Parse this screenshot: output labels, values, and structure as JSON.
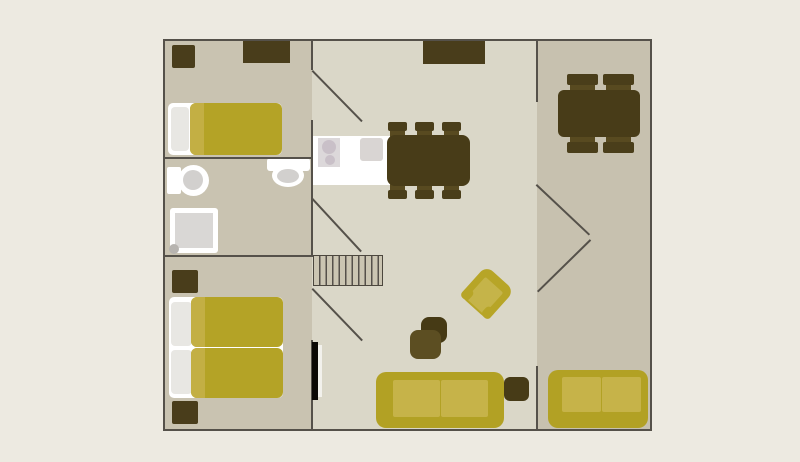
{
  "floorplan": {
    "title": "apartment-floor-plan",
    "background": "#edeae1",
    "palette": {
      "wall": "#55514a",
      "floor_side_rooms": "#c9c3b1",
      "floor_main_room": "#dad7c8",
      "floor_right_room": "#c7c1af",
      "furniture_dark_brown": "#493d1b",
      "table_brown": "#483c18",
      "chair_seat_brown": "#584a20",
      "textile_yellow": "#b4a326",
      "textile_yellow_light": "#c6b349",
      "fixture_white": "#ffffff",
      "fixture_gray": "#d9d6d3",
      "pillow_gray": "#e8e7e3",
      "stairs_fill": "#cbc5b2"
    },
    "layers": [
      {
        "name": "rooms",
        "items": [
          {
            "name": "bedroom-top-floor",
            "x": 163,
            "y": 39,
            "w": 149,
            "h": 119,
            "fill": "#c9c3b1"
          },
          {
            "name": "bathroom-floor",
            "x": 163,
            "y": 158,
            "w": 149,
            "h": 98,
            "fill": "#c9c3b1"
          },
          {
            "name": "bedroom-bottom-floor",
            "x": 163,
            "y": 256,
            "w": 149,
            "h": 175,
            "fill": "#c9c3b1"
          },
          {
            "name": "living-room-floor",
            "x": 312,
            "y": 39,
            "w": 225,
            "h": 392,
            "fill": "#dad7c8"
          },
          {
            "name": "right-room-floor",
            "x": 537,
            "y": 39,
            "w": 115,
            "h": 392,
            "fill": "#c7c1af"
          }
        ]
      },
      {
        "name": "furniture",
        "items": [
          {
            "name": "stairs",
            "x": 313,
            "y": 255,
            "w": 70,
            "h": 31,
            "fill": "#cbc5b2",
            "bg": "repeating-linear-gradient(90deg, rgba(0,0,0,0) 0px, rgba(0,0,0,0) 5.1px, #55504a 5.1px, #55504a 6.5px)",
            "border": "1.5px solid #4c473e"
          },
          {
            "name": "top-bedroom-nightstand",
            "x": 172,
            "y": 45,
            "w": 23,
            "h": 23,
            "fill": "#493d1b",
            "radius": "2px"
          },
          {
            "name": "top-bedroom-dresser",
            "x": 243,
            "y": 40,
            "w": 47,
            "h": 23,
            "fill": "#493d1b"
          },
          {
            "name": "single-bed-base",
            "x": 168,
            "y": 103,
            "w": 114,
            "h": 52,
            "fill": "#ffffff",
            "radius": "5px"
          },
          {
            "name": "single-bed-pillow",
            "x": 171,
            "y": 107,
            "w": 18,
            "h": 44,
            "fill": "#e8e7e3",
            "radius": "4px"
          },
          {
            "name": "single-bed-duvet",
            "x": 190,
            "y": 103,
            "w": 92,
            "h": 52,
            "fill": "#b4a326",
            "radius": "6px"
          },
          {
            "name": "single-bed-duvet-fold",
            "x": 190,
            "y": 103,
            "w": 14,
            "h": 52,
            "fill": "#c3af44",
            "radius": "6px 0 0 6px"
          },
          {
            "name": "toilet-left-tank",
            "x": 167,
            "y": 167,
            "w": 14,
            "h": 27,
            "fill": "#ffffff",
            "radius": "2px"
          },
          {
            "name": "toilet-left-bowl",
            "type": "ellipse",
            "x": 178,
            "y": 165,
            "w": 31,
            "h": 31,
            "fill": "#ffffff"
          },
          {
            "name": "toilet-left-bowl-inner",
            "type": "ellipse",
            "x": 183,
            "y": 170,
            "w": 20,
            "h": 20,
            "fill": "#d2d0ce"
          },
          {
            "name": "toilet-top-tank",
            "x": 267,
            "y": 158,
            "w": 43,
            "h": 13,
            "fill": "#ffffff",
            "radius": "3px"
          },
          {
            "name": "toilet-top-bowl",
            "type": "ellipse",
            "x": 272,
            "y": 164,
            "w": 32,
            "h": 23,
            "fill": "#ffffff"
          },
          {
            "name": "toilet-top-bowl-inner",
            "type": "ellipse",
            "x": 277,
            "y": 169,
            "w": 22,
            "h": 14,
            "fill": "#d2d0ce"
          },
          {
            "name": "shower-base",
            "x": 170,
            "y": 208,
            "w": 48,
            "h": 45,
            "fill": "#ffffff",
            "radius": "3px"
          },
          {
            "name": "shower-tray",
            "x": 175,
            "y": 213,
            "w": 38,
            "h": 35,
            "fill": "#d9d7d5"
          },
          {
            "name": "shower-drain",
            "type": "ellipse",
            "x": 169,
            "y": 244,
            "w": 10,
            "h": 10,
            "fill": "#b7b4b0"
          },
          {
            "name": "bottom-bedroom-nightstand-top",
            "x": 172,
            "y": 270,
            "w": 26,
            "h": 23,
            "fill": "#493d1b",
            "radius": "2px"
          },
          {
            "name": "bottom-bedroom-nightstand-bottom",
            "x": 172,
            "y": 401,
            "w": 26,
            "h": 23,
            "fill": "#493d1b",
            "radius": "2px"
          },
          {
            "name": "double-bed-base",
            "x": 169,
            "y": 297,
            "w": 114,
            "h": 101,
            "fill": "#ffffff",
            "radius": "5px"
          },
          {
            "name": "double-bed-pillow-top",
            "x": 171,
            "y": 302,
            "w": 21,
            "h": 44,
            "fill": "#e8e7e3",
            "radius": "4px"
          },
          {
            "name": "double-bed-pillow-bottom",
            "x": 171,
            "y": 350,
            "w": 21,
            "h": 44,
            "fill": "#e8e7e3",
            "radius": "4px"
          },
          {
            "name": "double-bed-duvet-top",
            "x": 191,
            "y": 297,
            "w": 92,
            "h": 50,
            "fill": "#b4a326",
            "radius": "6px"
          },
          {
            "name": "double-bed-duvet-top-fold",
            "x": 191,
            "y": 297,
            "w": 14,
            "h": 50,
            "fill": "#c3af44",
            "radius": "6px 0 0 6px"
          },
          {
            "name": "double-bed-duvet-bottom",
            "x": 191,
            "y": 348,
            "w": 92,
            "h": 50,
            "fill": "#b4a326",
            "radius": "6px"
          },
          {
            "name": "double-bed-duvet-bottom-fold",
            "x": 191,
            "y": 348,
            "w": 14,
            "h": 50,
            "fill": "#c3af44",
            "radius": "6px 0 0 6px"
          },
          {
            "name": "kitchen-counter",
            "x": 313,
            "y": 136,
            "w": 77,
            "h": 49,
            "fill": "#ffffff"
          },
          {
            "name": "stove-panel",
            "x": 318,
            "y": 138,
            "w": 22,
            "h": 29,
            "fill": "#dcd8da"
          },
          {
            "name": "stove-burner-large",
            "type": "ellipse",
            "x": 322,
            "y": 140,
            "w": 14,
            "h": 14,
            "fill": "#c9c0c8"
          },
          {
            "name": "stove-burner-small",
            "type": "ellipse",
            "x": 325,
            "y": 155,
            "w": 10,
            "h": 10,
            "fill": "#c9c0c8"
          },
          {
            "name": "kitchen-sink",
            "x": 360,
            "y": 138,
            "w": 23,
            "h": 23,
            "fill": "#d9d5d3",
            "radius": "3px"
          },
          {
            "name": "sideboard",
            "x": 423,
            "y": 40,
            "w": 62,
            "h": 24,
            "fill": "#493d1b"
          },
          {
            "name": "dining-chair-seat",
            "x": 390,
            "y": 128,
            "w": 15,
            "h": 10,
            "fill": "#584a20",
            "radius": "2px"
          },
          {
            "name": "dining-chair-seat",
            "x": 417,
            "y": 128,
            "w": 15,
            "h": 10,
            "fill": "#584a20",
            "radius": "2px"
          },
          {
            "name": "dining-chair-seat",
            "x": 444,
            "y": 128,
            "w": 15,
            "h": 10,
            "fill": "#584a20",
            "radius": "2px"
          },
          {
            "name": "dining-chair-seat",
            "x": 390,
            "y": 183,
            "w": 15,
            "h": 10,
            "fill": "#584a20",
            "radius": "2px"
          },
          {
            "name": "dining-chair-seat",
            "x": 417,
            "y": 183,
            "w": 15,
            "h": 10,
            "fill": "#584a20",
            "radius": "2px"
          },
          {
            "name": "dining-chair-seat",
            "x": 444,
            "y": 183,
            "w": 15,
            "h": 10,
            "fill": "#584a20",
            "radius": "2px"
          },
          {
            "name": "dining-table",
            "x": 387,
            "y": 135,
            "w": 83,
            "h": 51,
            "fill": "#483c18",
            "radius": "8px"
          },
          {
            "name": "dining-chair-back",
            "x": 388,
            "y": 122,
            "w": 19,
            "h": 9,
            "fill": "#4a3e1a",
            "radius": "2px"
          },
          {
            "name": "dining-chair-back",
            "x": 415,
            "y": 122,
            "w": 19,
            "h": 9,
            "fill": "#4a3e1a",
            "radius": "2px"
          },
          {
            "name": "dining-chair-back",
            "x": 442,
            "y": 122,
            "w": 19,
            "h": 9,
            "fill": "#4a3e1a",
            "radius": "2px"
          },
          {
            "name": "dining-chair-back",
            "x": 388,
            "y": 190,
            "w": 19,
            "h": 9,
            "fill": "#4a3e1a",
            "radius": "2px"
          },
          {
            "name": "dining-chair-back",
            "x": 415,
            "y": 190,
            "w": 19,
            "h": 9,
            "fill": "#4a3e1a",
            "radius": "2px"
          },
          {
            "name": "dining-chair-back",
            "x": 442,
            "y": 190,
            "w": 19,
            "h": 9,
            "fill": "#4a3e1a",
            "radius": "2px"
          },
          {
            "name": "right-room-chair-seat",
            "x": 570,
            "y": 83,
            "w": 25,
            "h": 10,
            "fill": "#584a20",
            "radius": "2px"
          },
          {
            "name": "right-room-chair-seat",
            "x": 606,
            "y": 83,
            "w": 25,
            "h": 10,
            "fill": "#584a20",
            "radius": "2px"
          },
          {
            "name": "right-room-chair-seat",
            "x": 570,
            "y": 134,
            "w": 25,
            "h": 10,
            "fill": "#584a20",
            "radius": "2px"
          },
          {
            "name": "right-room-chair-seat",
            "x": 606,
            "y": 134,
            "w": 25,
            "h": 10,
            "fill": "#584a20",
            "radius": "2px"
          },
          {
            "name": "right-room-table",
            "x": 558,
            "y": 90,
            "w": 82,
            "h": 47,
            "fill": "#483c18",
            "radius": "6px"
          },
          {
            "name": "right-room-chair-back",
            "x": 567,
            "y": 74,
            "w": 31,
            "h": 11,
            "fill": "#4a3e1a",
            "radius": "2px"
          },
          {
            "name": "right-room-chair-back",
            "x": 603,
            "y": 74,
            "w": 31,
            "h": 11,
            "fill": "#4a3e1a",
            "radius": "2px"
          },
          {
            "name": "right-room-chair-back",
            "x": 567,
            "y": 142,
            "w": 31,
            "h": 11,
            "fill": "#4a3e1a",
            "radius": "2px"
          },
          {
            "name": "right-room-chair-back",
            "x": 603,
            "y": 142,
            "w": 31,
            "h": 11,
            "fill": "#4a3e1a",
            "radius": "2px"
          },
          {
            "name": "pouf-back",
            "x": 421,
            "y": 317,
            "w": 26,
            "h": 26,
            "fill": "#463a15",
            "radius": "8px"
          },
          {
            "name": "pouf-front",
            "x": 410,
            "y": 330,
            "w": 31,
            "h": 29,
            "fill": "#5c4e22",
            "radius": "8px"
          },
          {
            "name": "armchair",
            "type": "group",
            "x": 468,
            "y": 273,
            "w": 38,
            "h": 40,
            "rotate": 42,
            "children": [
              {
                "name": "armchair-body",
                "x": 0,
                "y": 0,
                "w": 38,
                "h": 40,
                "fill": "#b7a527",
                "radius": "9px"
              },
              {
                "name": "armchair-seat",
                "x": 7,
                "y": 9,
                "w": 24,
                "h": 29,
                "fill": "#c5b449",
                "radius": "2px"
              },
              {
                "name": "armchair-foot-left",
                "x": 0,
                "y": 28,
                "w": 10,
                "h": 12,
                "fill": "#b7a527",
                "radius": "4px"
              },
              {
                "name": "armchair-foot-right",
                "x": 28,
                "y": 28,
                "w": 10,
                "h": 12,
                "fill": "#b7a527",
                "radius": "4px"
              }
            ]
          },
          {
            "name": "living-sofa-body",
            "x": 376,
            "y": 372,
            "w": 128,
            "h": 56,
            "fill": "#b2a124",
            "radius": "10px"
          },
          {
            "name": "living-sofa-cushion-left",
            "x": 393,
            "y": 380,
            "w": 47,
            "h": 37,
            "fill": "#c6b349",
            "radius": "2px"
          },
          {
            "name": "living-sofa-cushion-right",
            "x": 441,
            "y": 380,
            "w": 47,
            "h": 37,
            "fill": "#c6b349",
            "radius": "2px"
          },
          {
            "name": "living-side-table",
            "x": 504,
            "y": 377,
            "w": 25,
            "h": 24,
            "fill": "#473b17",
            "radius": "6px"
          },
          {
            "name": "right-sofa-body",
            "x": 548,
            "y": 370,
            "w": 100,
            "h": 58,
            "fill": "#b2a124",
            "radius": "10px"
          },
          {
            "name": "right-sofa-cushion-left",
            "x": 562,
            "y": 377,
            "w": 39,
            "h": 35,
            "fill": "#c6b349",
            "radius": "2px"
          },
          {
            "name": "right-sofa-cushion-right",
            "x": 602,
            "y": 377,
            "w": 39,
            "h": 35,
            "fill": "#c6b349",
            "radius": "2px"
          }
        ]
      },
      {
        "name": "walls",
        "items": [
          {
            "name": "outer-wall-top",
            "x": 163,
            "y": 39,
            "w": 489,
            "h": 2,
            "fill": "#55514a"
          },
          {
            "name": "outer-wall-bottom",
            "x": 163,
            "y": 429,
            "w": 489,
            "h": 2,
            "fill": "#55514a"
          },
          {
            "name": "outer-wall-left",
            "x": 163,
            "y": 39,
            "w": 2,
            "h": 392,
            "fill": "#55514a"
          },
          {
            "name": "outer-wall-right",
            "x": 650,
            "y": 39,
            "w": 2,
            "h": 392,
            "fill": "#55514a"
          },
          {
            "name": "wall-bathroom-top",
            "x": 163,
            "y": 157,
            "w": 150,
            "h": 2,
            "fill": "#55514a"
          },
          {
            "name": "wall-bathroom-bottom",
            "x": 163,
            "y": 255,
            "w": 150,
            "h": 2,
            "fill": "#55514a"
          },
          {
            "name": "wall-left-column-upper",
            "x": 311,
            "y": 39,
            "w": 2,
            "h": 31,
            "fill": "#55514a"
          },
          {
            "name": "wall-left-column-middle",
            "x": 311,
            "y": 120,
            "w": 2,
            "h": 136,
            "fill": "#55514a"
          },
          {
            "name": "wall-left-column-lower",
            "x": 311,
            "y": 340,
            "w": 2,
            "h": 91,
            "fill": "#55514a"
          },
          {
            "name": "wall-right-room-upper",
            "x": 536,
            "y": 39,
            "w": 2,
            "h": 63,
            "fill": "#55514a"
          },
          {
            "name": "wall-right-room-lower",
            "x": 536,
            "y": 366,
            "w": 2,
            "h": 65,
            "fill": "#55514a"
          }
        ]
      },
      {
        "name": "door_swings",
        "items": [
          {
            "name": "door-swing-top-bedroom",
            "type": "line",
            "x1": 313,
            "y1": 70,
            "x2": 363,
            "y2": 121,
            "color": "#55514a",
            "thickness": 1.5
          },
          {
            "name": "door-swing-bathroom",
            "type": "line",
            "x1": 313,
            "y1": 198,
            "x2": 362,
            "y2": 251,
            "color": "#55514a",
            "thickness": 1.5
          },
          {
            "name": "door-swing-bottom-bedroom",
            "type": "line",
            "x1": 313,
            "y1": 288,
            "x2": 363,
            "y2": 340,
            "color": "#55514a",
            "thickness": 1.5
          },
          {
            "name": "door-swing-right-room-upper",
            "type": "line",
            "x1": 537,
            "y1": 184,
            "x2": 590,
            "y2": 234,
            "color": "#55514a",
            "thickness": 1.5
          },
          {
            "name": "door-swing-right-room-lower",
            "type": "line",
            "x1": 537,
            "y1": 291,
            "x2": 590,
            "y2": 239,
            "color": "#55514a",
            "thickness": 1.5
          }
        ]
      },
      {
        "name": "overlays",
        "items": [
          {
            "name": "wall-mounted-panel",
            "x": 312,
            "y": 342,
            "w": 6,
            "h": 58,
            "fill": "#0a0804"
          },
          {
            "name": "wall-mounted-panel-gap",
            "x": 318,
            "y": 345,
            "w": 4,
            "h": 52,
            "fill": "#f2f1ec"
          }
        ]
      }
    ]
  }
}
